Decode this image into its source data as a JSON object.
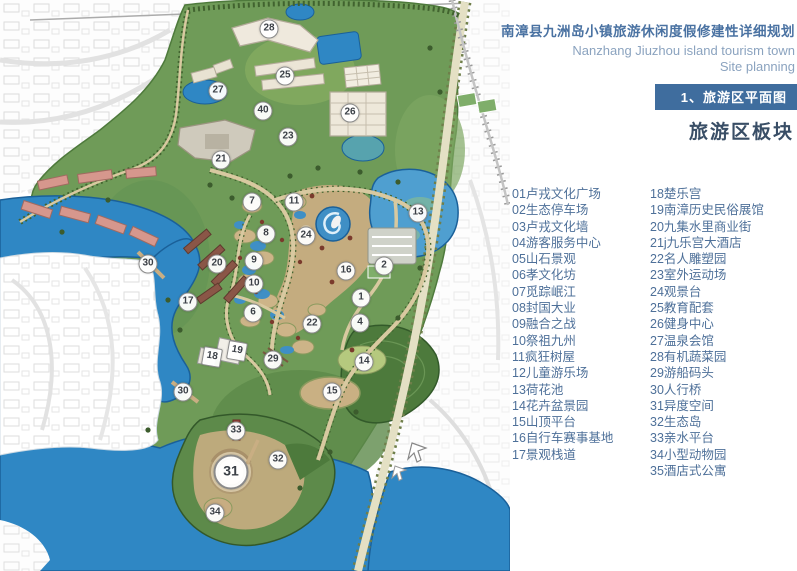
{
  "header": {
    "title_cn": "南漳县九洲岛小镇旅游休闲度假修建性详细规划",
    "title_en_line1": "Nanzhang Jiuzhou island tourism town",
    "title_en_line2": "Site planning",
    "badge": "1、旅游区平面图",
    "subtitle": "旅游区板块"
  },
  "legend": {
    "col1": [
      "01卢戎文化广场",
      "02生态停车场",
      "03卢戎文化墙",
      "04游客服务中心",
      "05山石景观",
      "06孝文化坊",
      "07觅踪岷江",
      "08封国大业",
      "09融合之战",
      "10祭祖九州",
      "11疯狂树屋",
      "12儿童游乐场",
      "13荷花池",
      "14花卉盆景园",
      "15山顶平台",
      "16自行车赛事基地",
      "17景观栈道"
    ],
    "col2": [
      "18楚乐宫",
      "19南漳历史民俗展馆",
      "20九集水里商业街",
      "21j九乐宫大酒店",
      "22名人雕塑园",
      "23室外运动场",
      "24观景台",
      "25教育配套",
      "26健身中心",
      "27温泉会馆",
      "28有机蔬菜园",
      "29游船码头",
      "30人行桥",
      "31异度空间",
      "32生态岛",
      "33亲水平台",
      "34小型动物园",
      "35酒店式公寓"
    ]
  },
  "map": {
    "markers": [
      {
        "label": "28",
        "x": 269,
        "y": 29
      },
      {
        "label": "25",
        "x": 285,
        "y": 76
      },
      {
        "label": "27",
        "x": 218,
        "y": 91
      },
      {
        "label": "40",
        "x": 263,
        "y": 111
      },
      {
        "label": "26",
        "x": 350,
        "y": 113
      },
      {
        "label": "23",
        "x": 288,
        "y": 137
      },
      {
        "label": "21",
        "x": 221,
        "y": 160
      },
      {
        "label": "7",
        "x": 252,
        "y": 202
      },
      {
        "label": "11",
        "x": 294,
        "y": 202
      },
      {
        "label": "13",
        "x": 418,
        "y": 213
      },
      {
        "label": "8",
        "x": 266,
        "y": 234
      },
      {
        "label": "24",
        "x": 306,
        "y": 236
      },
      {
        "label": "9",
        "x": 254,
        "y": 261
      },
      {
        "label": "20",
        "x": 217,
        "y": 264
      },
      {
        "label": "30",
        "x": 148,
        "y": 264
      },
      {
        "label": "2",
        "x": 384,
        "y": 266
      },
      {
        "label": "16",
        "x": 346,
        "y": 271
      },
      {
        "label": "10",
        "x": 254,
        "y": 284
      },
      {
        "label": "1",
        "x": 361,
        "y": 298
      },
      {
        "label": "17",
        "x": 188,
        "y": 302
      },
      {
        "label": "6",
        "x": 253,
        "y": 313
      },
      {
        "label": "4",
        "x": 360,
        "y": 323
      },
      {
        "label": "22",
        "x": 312,
        "y": 324
      },
      {
        "label": "19",
        "x": 237,
        "y": 351,
        "shape": "square"
      },
      {
        "label": "18",
        "x": 212,
        "y": 357,
        "shape": "square"
      },
      {
        "label": "29",
        "x": 273,
        "y": 360
      },
      {
        "label": "14",
        "x": 364,
        "y": 362
      },
      {
        "label": "30",
        "x": 183,
        "y": 392
      },
      {
        "label": "15",
        "x": 332,
        "y": 392
      },
      {
        "label": "33",
        "x": 236,
        "y": 431
      },
      {
        "label": "32",
        "x": 278,
        "y": 460
      },
      {
        "label": "31",
        "x": 231,
        "y": 472,
        "size": "lg"
      },
      {
        "label": "34",
        "x": 215,
        "y": 513
      }
    ]
  },
  "colors": {
    "badge_bg": "#3f6d9e",
    "title_blue": "#4a72a2",
    "english_blue": "#8ba3bf",
    "subtitle_dark": "#394e66",
    "legend_blue": "#4e7099",
    "water_blue": "#2f87c4",
    "land_green": "#6f9b58",
    "forest_green": "#4e7a3c",
    "path_tan": "#c9ae83",
    "building_pink": "#d6978d"
  }
}
